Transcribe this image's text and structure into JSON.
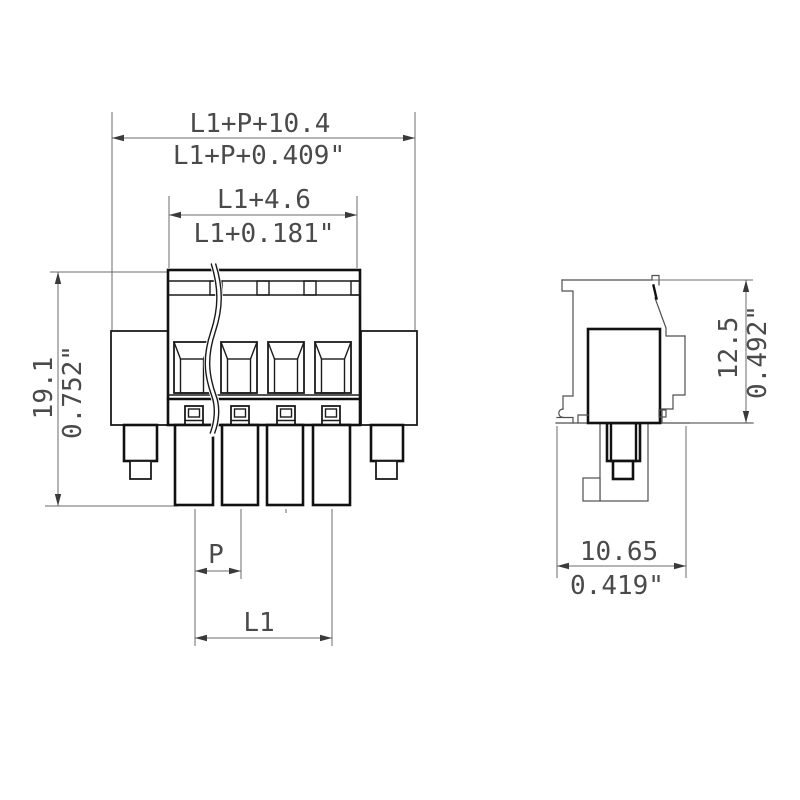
{
  "drawing_title": "pluggable terminal block dimension drawing",
  "front_view": {
    "dim_overall_width_mm": "L1+P+10.4",
    "dim_overall_width_inch": "L1+P+0.409\"",
    "dim_inner_width_mm": "L1+4.6",
    "dim_inner_width_inch": "L1+0.181\"",
    "dim_height_mm": "19.1",
    "dim_height_inch": "0.752\"",
    "dim_pitch": "P",
    "dim_length": "L1"
  },
  "side_view": {
    "dim_height_mm": "12.5",
    "dim_height_inch": "0.492\"",
    "dim_width_mm": "10.65",
    "dim_width_inch": "0.419\""
  },
  "colors": {
    "background": "#ffffff",
    "outline_bold": "#111111",
    "outline_medium": "#1b1b1b",
    "outline_thin": "#4f4f4f",
    "dimension_line": "#6b6b6b",
    "text": "#4a4a4a"
  }
}
